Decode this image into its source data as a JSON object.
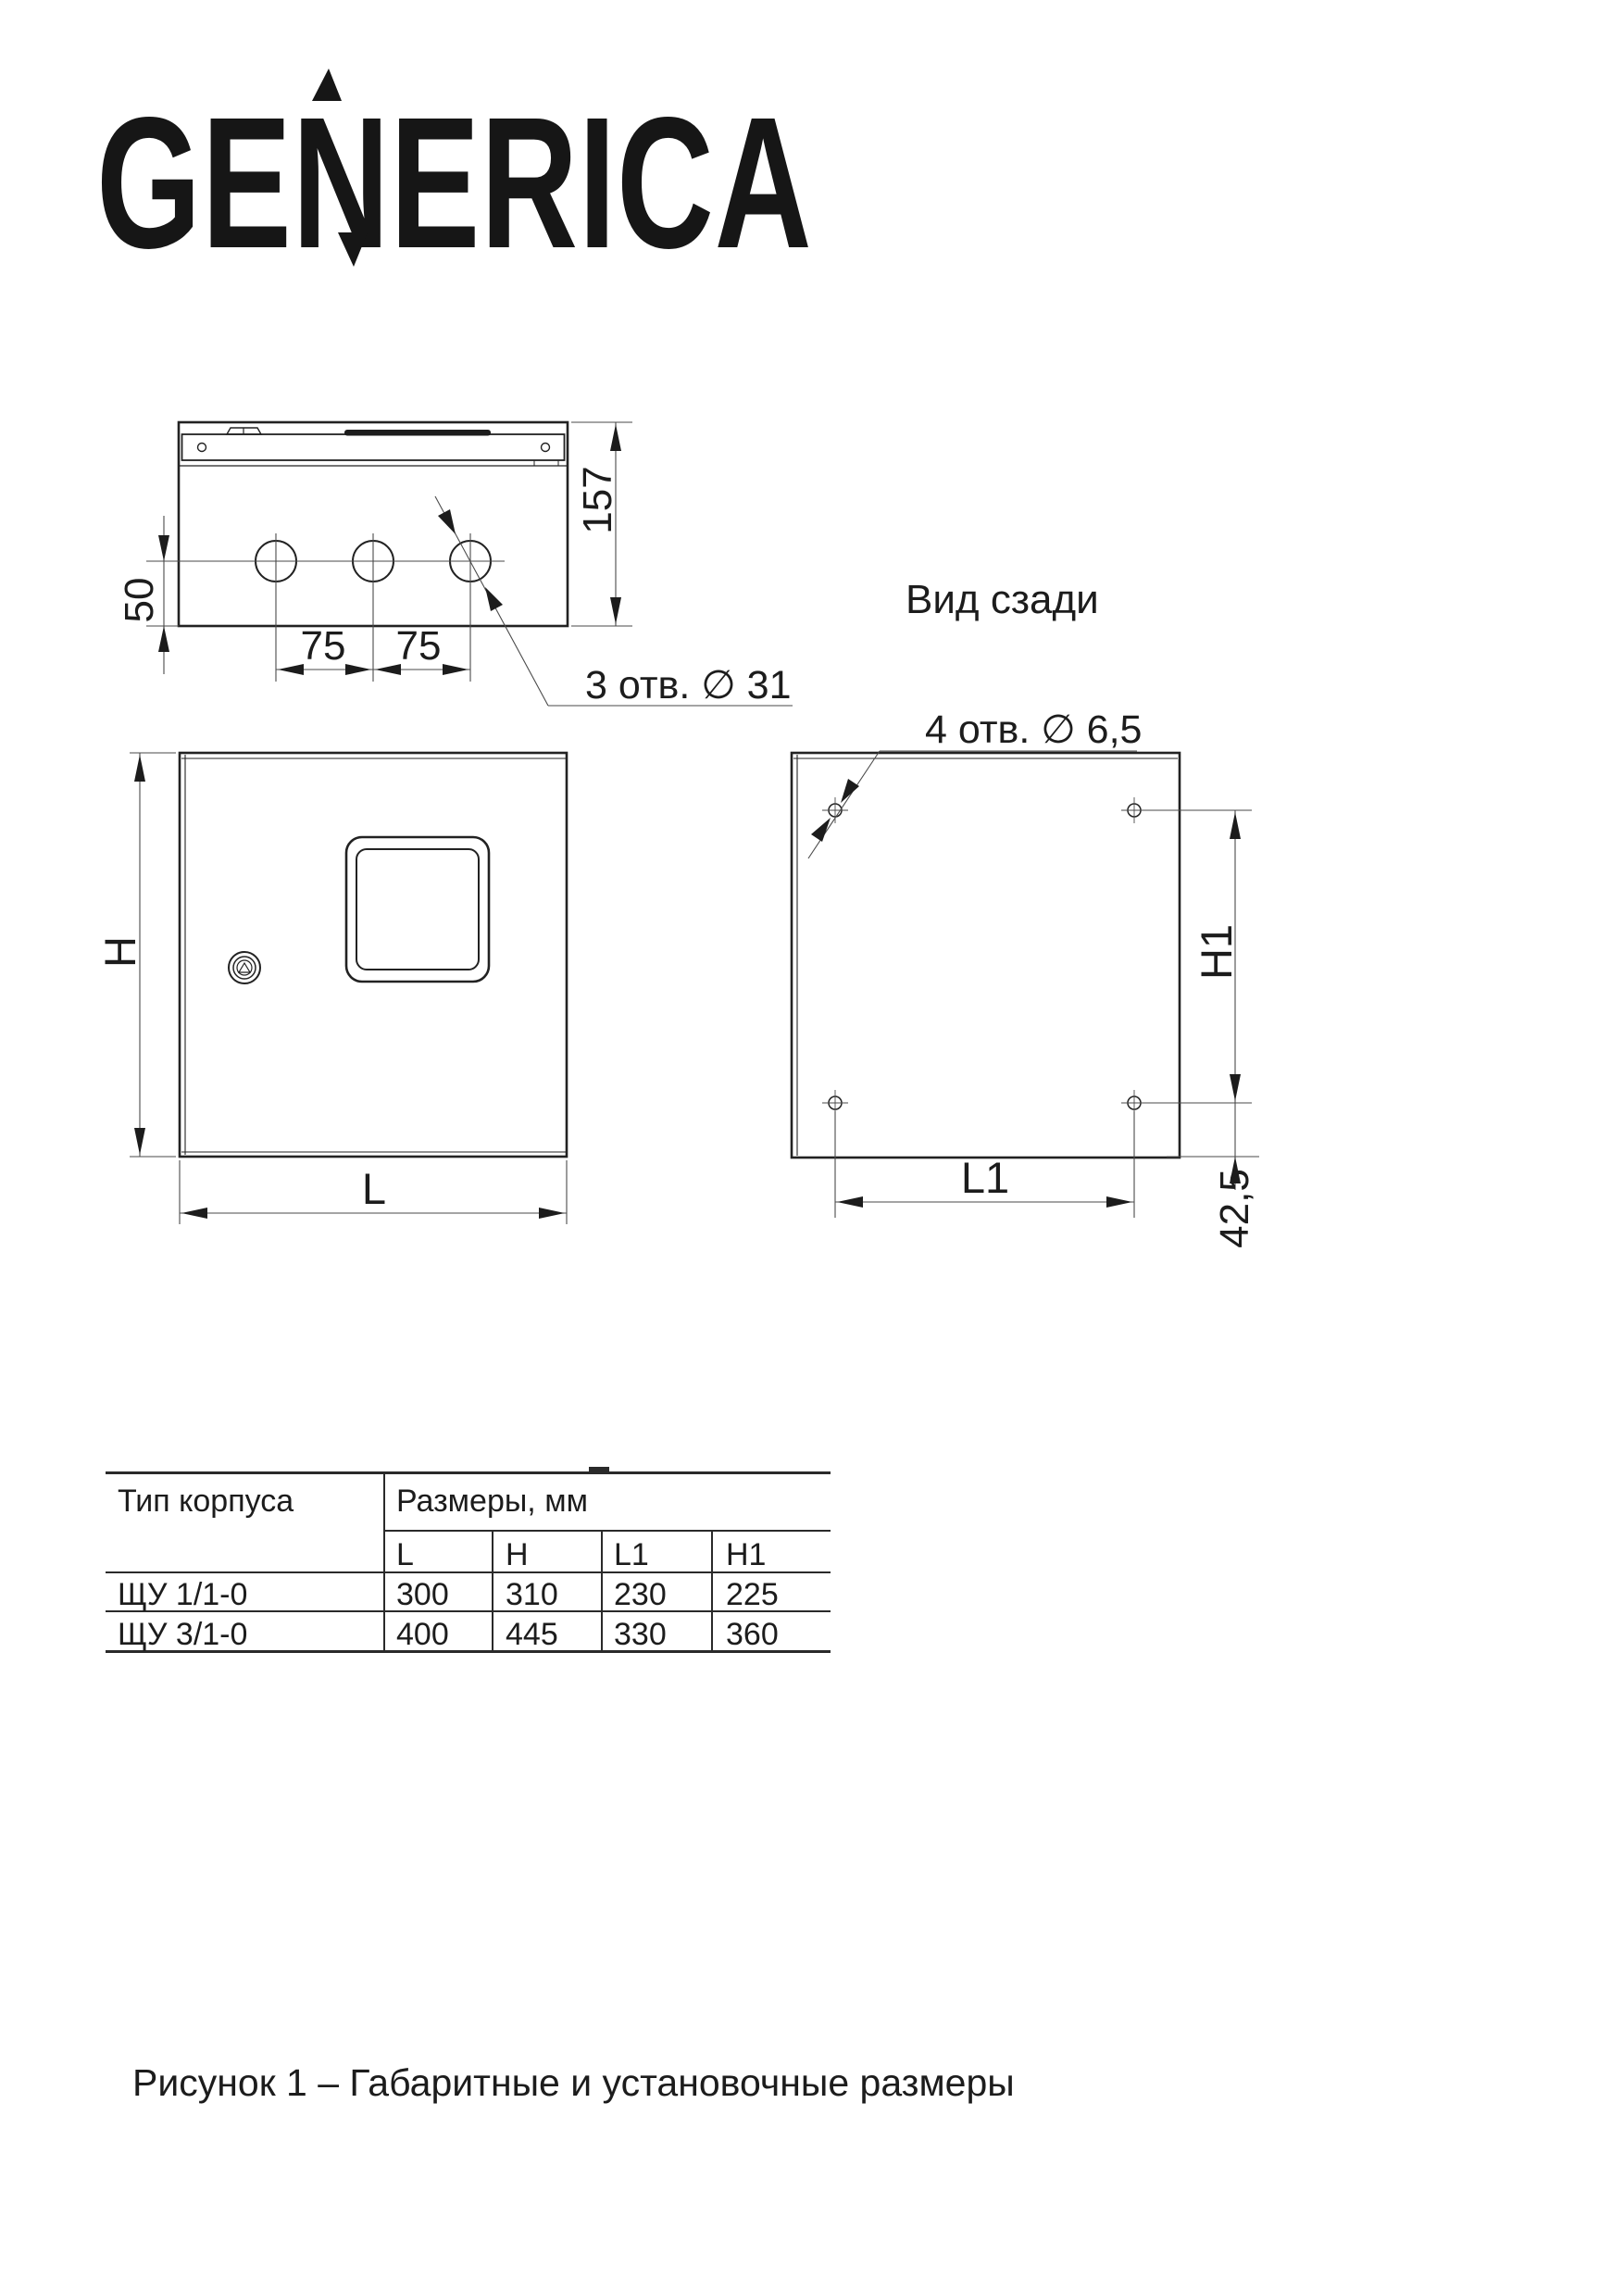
{
  "brand": {
    "logo_text": "GENERICA"
  },
  "colors": {
    "ink": "#1c1c1c",
    "line": "#2a2a2a",
    "thin_line": "#4a4a4a"
  },
  "views": {
    "top": {
      "dim_depth": "157",
      "dim_hole_offset": "50",
      "dim_spacing_1": "75",
      "dim_spacing_2": "75",
      "holes_note": "3 отв.  ∅ 31"
    },
    "front": {
      "dim_h": "H",
      "dim_l": "L"
    },
    "rear": {
      "title": "Вид сзади",
      "holes_note": "4 отв. ∅ 6,5",
      "dim_h1": "H1",
      "dim_l1": "L1",
      "dim_bottom_offset": "42,5"
    }
  },
  "table": {
    "col1_header": "Тип корпуса",
    "group_header": "Размеры, мм",
    "sub_headers": [
      "L",
      "H",
      "L1",
      "H1"
    ],
    "rows": [
      {
        "type": "ЩУ 1/1-0",
        "values": [
          "300",
          "310",
          "230",
          "225"
        ]
      },
      {
        "type": "ЩУ 3/1-0",
        "values": [
          "400",
          "445",
          "330",
          "360"
        ]
      }
    ]
  },
  "caption": "Рисунок 1 – Габаритные и установочные размеры"
}
